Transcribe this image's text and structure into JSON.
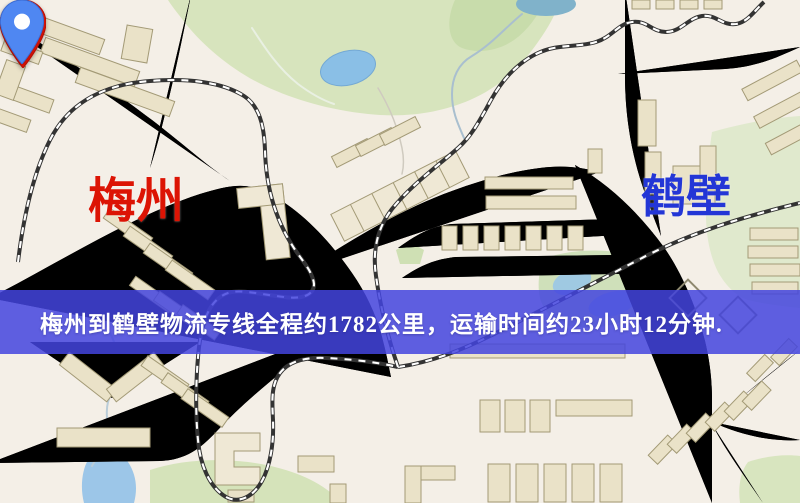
{
  "banner": {
    "text": "梅州到鹤壁物流专线全程约1782公里，运输时间约23小时12分钟.",
    "bg_color": "rgba(67,68,222,0.85)",
    "text_color": "#ffffff"
  },
  "origin": {
    "name": "梅州",
    "pin_icon": "map-pin-icon",
    "pin_color": "#e8150a",
    "label_color": "#dc1404"
  },
  "destination": {
    "name": "鹤壁",
    "pin_icon": "map-pin-icon",
    "pin_color": "#4f87f2",
    "label_color": "#2336d6"
  },
  "map_colors": {
    "background": "#f4efe7",
    "road": "#f4d279",
    "road_casing": "#e2b25f",
    "building": "#eae2c8",
    "park_green": "#d7e4bd",
    "water": "#8abfe6",
    "railway_dark": "#333333"
  }
}
